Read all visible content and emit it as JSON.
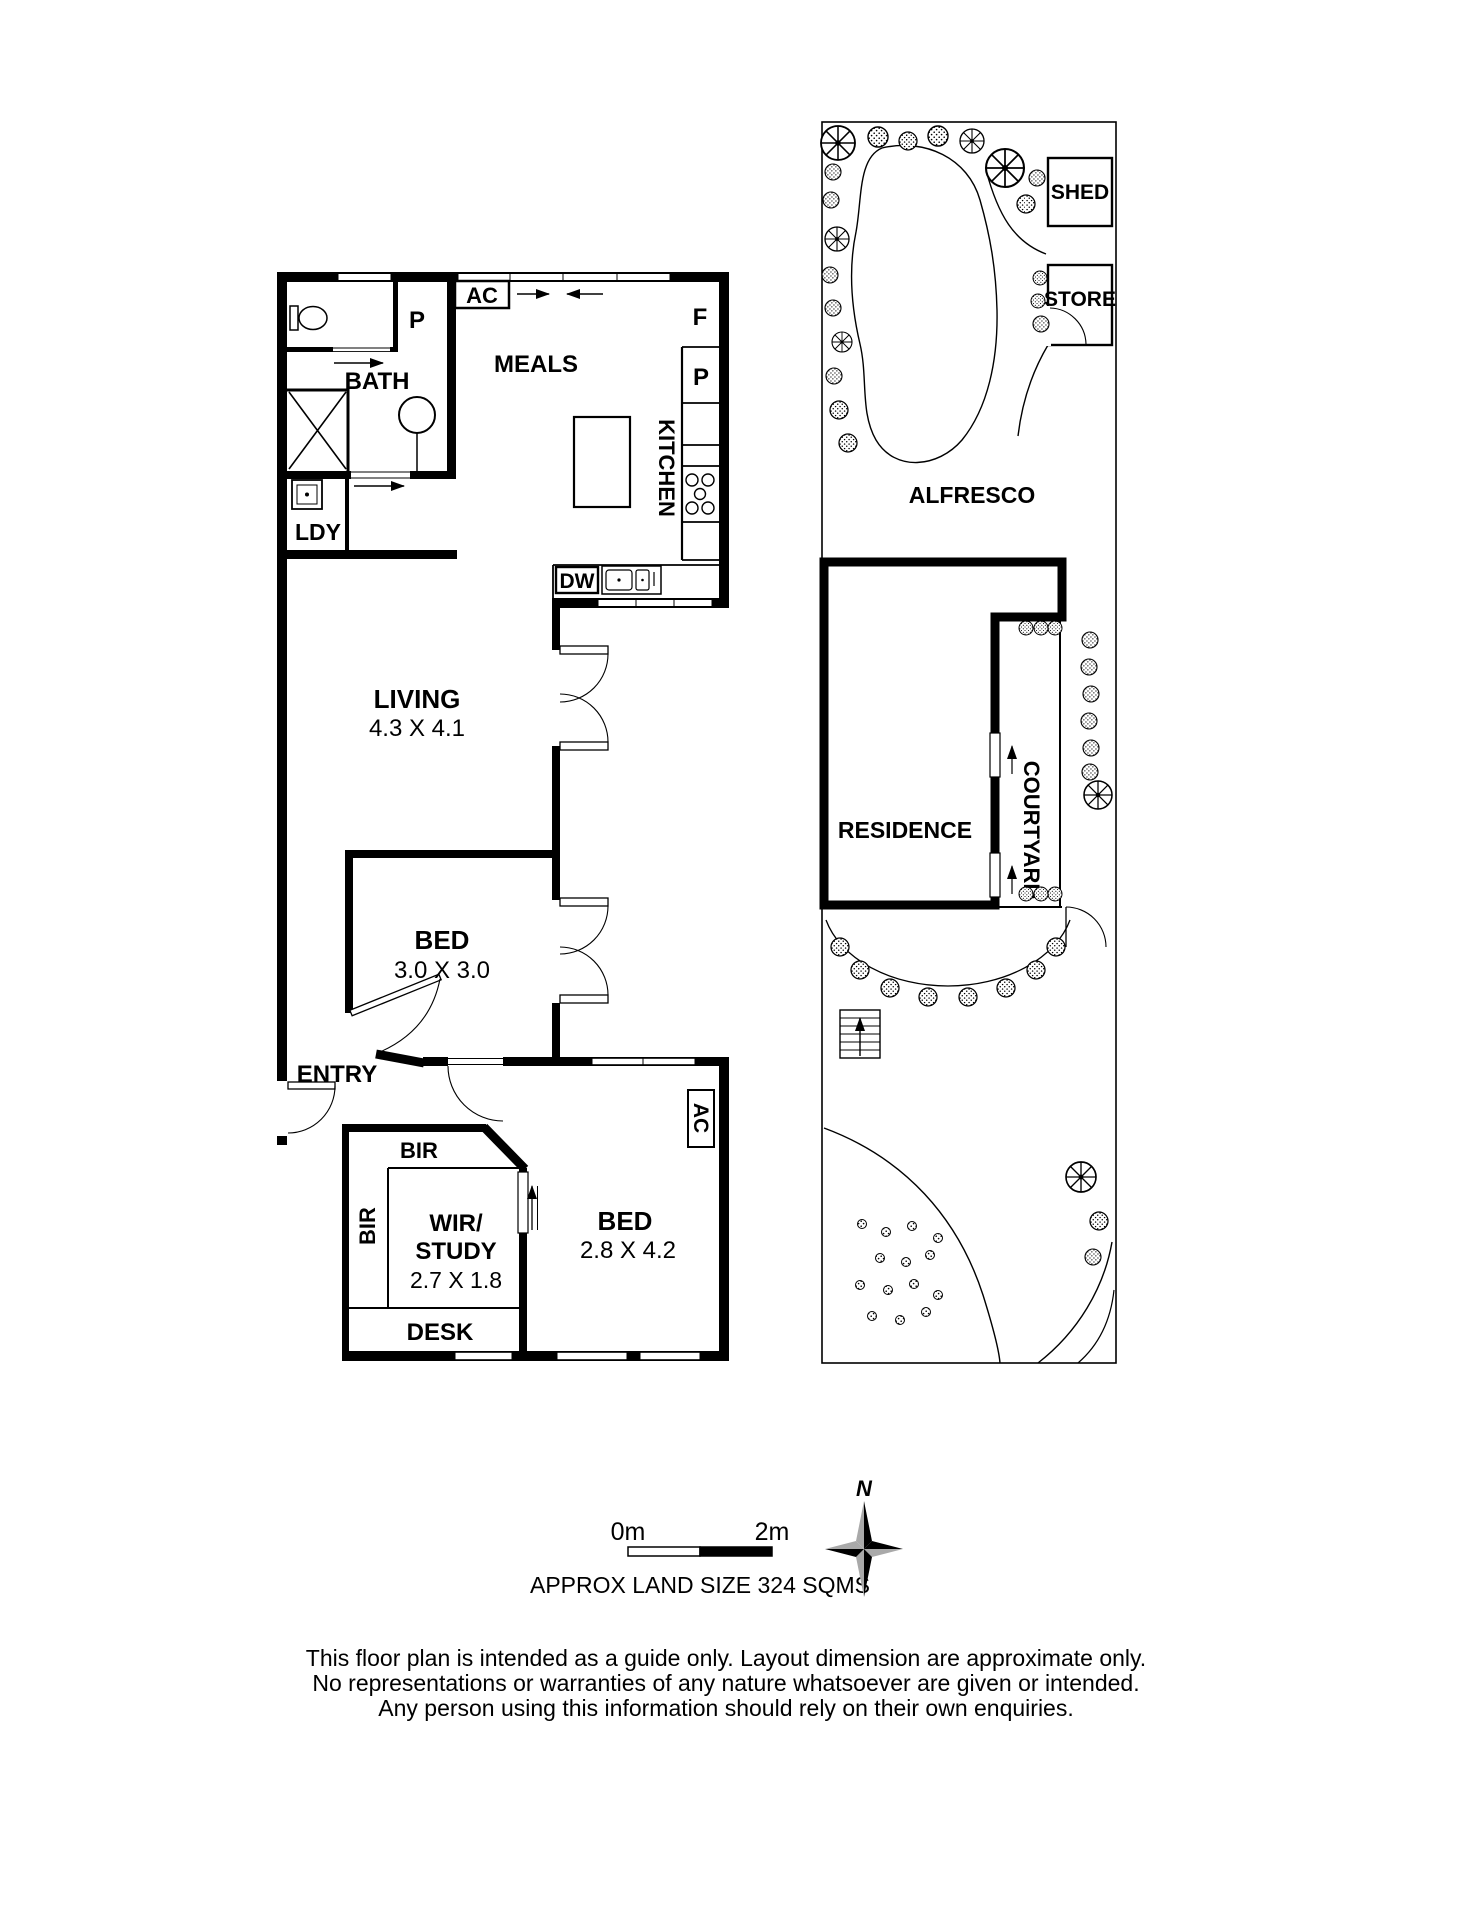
{
  "unit_plan": {
    "rooms": {
      "bath": "BATH",
      "laundry": "LDY",
      "meals": "MEALS",
      "kitchen": "KITCHEN",
      "living": {
        "name": "LIVING",
        "dims": "4.3 X 4.1"
      },
      "bed1": {
        "name": "BED",
        "dims": "3.0 X 3.0"
      },
      "entry": "ENTRY",
      "bed2": {
        "name": "BED",
        "dims": "2.8 X 4.2"
      },
      "wir_study": {
        "line1": "WIR/",
        "line2": "STUDY",
        "dims": "2.7 X 1.8"
      },
      "desk": "DESK",
      "bir_top": "BIR",
      "bir_side": "BIR"
    },
    "fixtures": {
      "ac_meals": "AC",
      "ac_bed2": "AC",
      "pantry_hall": "P",
      "pantry_kitchen": "P",
      "fridge": "F",
      "dishwasher": "DW"
    }
  },
  "site_plan": {
    "shed": "SHED",
    "store": "STORE",
    "alfresco": "ALFRESCO",
    "residence": "RESIDENCE",
    "courtyard": "COURTYARD"
  },
  "footer": {
    "scale_start": "0m",
    "scale_end": "2m",
    "land_size": "APPROX LAND SIZE 324 SQMS",
    "compass_north": "N",
    "disclaimer": [
      "This floor plan is intended as a guide only. Layout dimension are approximate only.",
      "No representations or warranties of any nature whatsoever are given or intended.",
      "Any person using this information should rely on their own enquiries."
    ]
  },
  "colors": {
    "ink": "#000000",
    "background": "#ffffff",
    "compass_light": "#a9a9a9"
  }
}
